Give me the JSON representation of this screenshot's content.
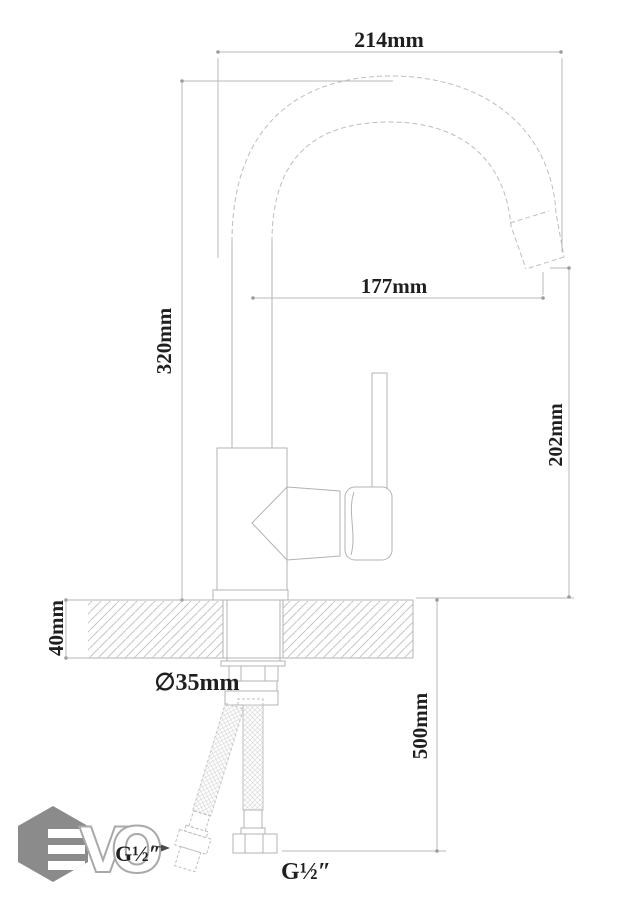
{
  "page": {
    "background": "#ffffff",
    "width": 635,
    "height": 900
  },
  "drawing": {
    "kind": "kitchen-faucet installation dimension diagram",
    "colors": {
      "line": "#b3b3b3",
      "dimension_line": "#b9b9b9",
      "text": "#1f1f1f",
      "hatch": "#c6c6c6",
      "logo": "#8b8b8b"
    },
    "dimensions": {
      "spout_width": {
        "label": "214mm"
      },
      "spout_reach": {
        "label": "177mm"
      },
      "total_height": {
        "label": "320mm"
      },
      "outlet_height": {
        "label": "202mm"
      },
      "counter_thickness": {
        "label": "40mm"
      },
      "hole_diameter": {
        "label": "∅35mm"
      },
      "hose_length": {
        "label": "500mm"
      },
      "thread_main": {
        "label": "G½″"
      },
      "thread_hose": {
        "label": "G½″"
      }
    },
    "logo": {
      "name": "EVO",
      "letter_v": "V",
      "letter_o": "O"
    }
  }
}
